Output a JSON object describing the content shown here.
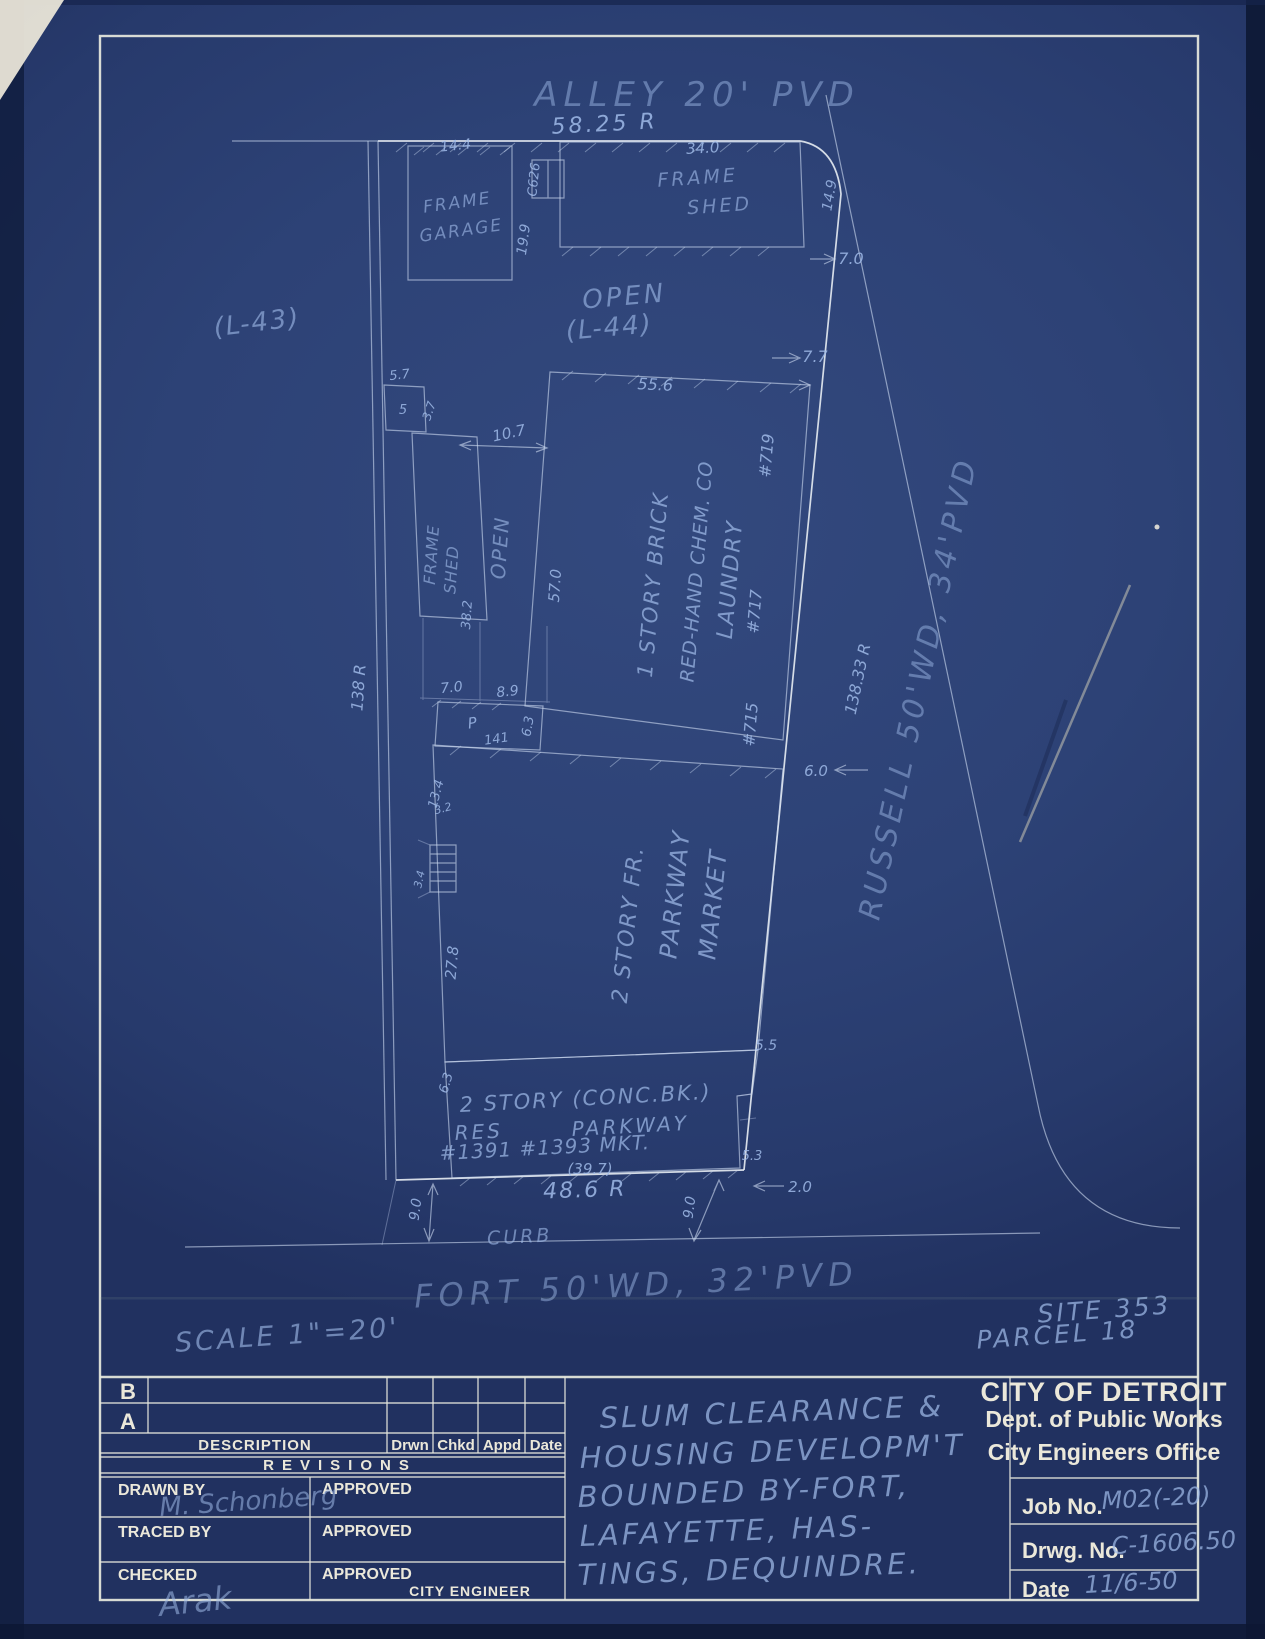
{
  "plan": {
    "streets": {
      "alley": "ALLEY 20' PVD",
      "alley_frontage": "58.25 R",
      "russell": "RUSSELL 50'WD, 34'PVD",
      "russell_frontage": "138.33 R",
      "west_frontage": "138 R",
      "fort": "FORT 50'WD, 32'PVD",
      "fort_frontage": "48.6 R",
      "curb": "CURB"
    },
    "lots": {
      "l43": "(L-43)",
      "open": "OPEN",
      "l44": "(L-44)"
    },
    "buildings": {
      "garage_1": "FRAME",
      "garage_2": "GARAGE",
      "shed_top_1": "FRAME",
      "shed_top_2": "SHED",
      "shed_left_1": "FRAME",
      "shed_left_2": "SHED",
      "open_strip": "OPEN",
      "meter": "C626",
      "brick_1": "1 STORY BRICK",
      "brick_2": "RED-HAND CHEM. CO",
      "brick_3": "LAUNDRY",
      "no_719": "#719",
      "no_717": "#717",
      "no_715": "#715",
      "porch": "P",
      "porch_no": "141",
      "market_1": "2 STORY FR.",
      "market_2": "PARKWAY",
      "market_3": "MARKET",
      "conc_1": "2 STORY (CONC.BK.)",
      "conc_2a": "RES",
      "conc_2b": "PARKWAY",
      "conc_3": "#1391 #1393 MKT.",
      "conc_width": "(39.7)"
    },
    "dims": {
      "d14_4": "14.4",
      "d19_9": "19.9",
      "d34_0": "34.0",
      "d14_9": "14.9",
      "d7_0a": "7.0",
      "d7_7": "7.7",
      "d5_7": "5.7",
      "d5": "5",
      "d3_7": "3.7",
      "d10_7": "10.7",
      "d55_6": "55.6",
      "d57_0": "57.0",
      "d38_2": "38.2",
      "d7_0b": "7.0",
      "d8_9": "8.9",
      "d6_3a": "6.3",
      "d6_0": "6.0",
      "d13_4": "13.4",
      "d27_8": "27.8",
      "d3_2": "3.2",
      "d3_4": "3.4",
      "d5_5": "5.5",
      "d6_3b": "6.3",
      "d5_3": "5.3",
      "d2_0": "2.0",
      "d9_0a": "9.0",
      "d9_0b": "9.0"
    },
    "notes": {
      "scale": "SCALE 1\"=20'",
      "site": "SITE 353",
      "parcel": "PARCEL 18"
    }
  },
  "title_block": {
    "agency": {
      "line1": "CITY OF DETROIT",
      "line2": "Dept. of Public Works",
      "line3": "City Engineers Office"
    },
    "fields": {
      "job_label": "Job No.",
      "job_value": "M02(-20)",
      "drwg_label": "Drwg. No.",
      "drwg_value": "C-1606.50",
      "date_label": "Date",
      "date_value": "11/6-50"
    },
    "revisions": {
      "row_b": "B",
      "row_a": "A",
      "description": "DESCRIPTION",
      "drwn": "Drwn",
      "chkd": "Chkd",
      "appd": "Appd",
      "date": "Date",
      "title": "REVISIONS"
    },
    "signoff": {
      "drawn_by": "DRAWN BY",
      "traced_by": "TRACED BY",
      "checked": "CHECKED",
      "approved": "APPROVED",
      "city_engineer": "CITY ENGINEER",
      "drawn_sig": "M. Schonberg",
      "checked_sig": "Arak"
    },
    "project": {
      "line1": "SLUM CLEARANCE &",
      "line2": "HOUSING DEVELOPM'T",
      "line3": "BOUNDED BY-FORT,",
      "line4": "LAFAYETTE, HAS-",
      "line5": "TINGS, DEQUINDRE."
    }
  },
  "colors": {
    "paper": "#2d4276",
    "printed_ink": "#ebe8da",
    "hand_ink": "#9fbae8",
    "bright_line": "#e8edf3"
  }
}
